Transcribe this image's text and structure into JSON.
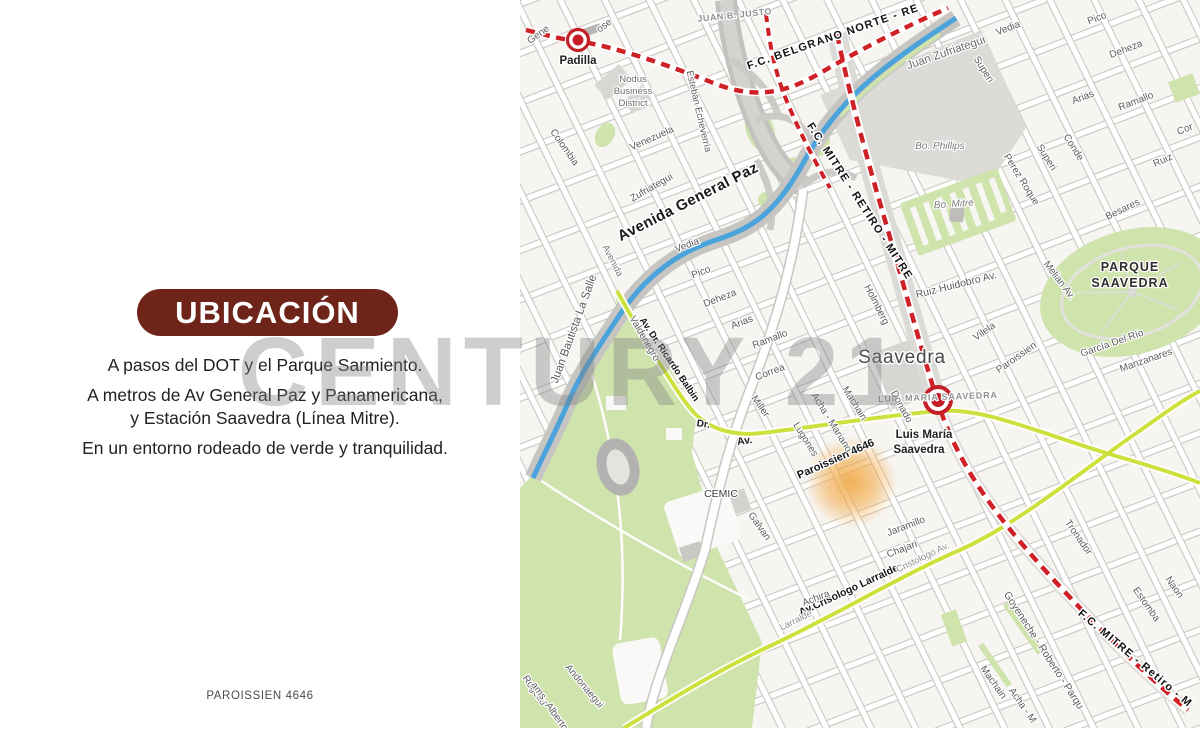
{
  "left_panel": {
    "title": "UBICACIÓN",
    "lines": [
      "A pasos del DOT y el Parque Sarmiento.",
      "A metros de Av General Paz y Panamericana,",
      "y Estación Saavedra (Línea Mitre).",
      "En un entorno rodeado de verde y tranquilidad."
    ],
    "footer": "PAROISSIEN 4646",
    "accent_color": "#6e2418"
  },
  "watermark": "CENTURY 21",
  "map": {
    "place": "Saavedra",
    "property_marker": "Paroissien 4646",
    "colors": {
      "railway_red": "#cf2026",
      "avenue_green": "#cde13e",
      "park_green": "#cfe3ad",
      "highway_blue": "#4aa3da",
      "highlight_orange": "#f1a43b",
      "station_red": "#c41e28",
      "map_background": "#f7f5f2"
    },
    "stations": [
      {
        "name": "Padilla"
      },
      {
        "name": "Luis María Saavedra"
      }
    ],
    "labels": [
      {
        "t": "F.C. MITRE - RETIRO - MITRE",
        "x": 337,
        "y": 203,
        "r": 57,
        "s": 11,
        "w": "bold",
        "c": "#121212",
        "ls": 1.2,
        "h": 3
      },
      {
        "t": "F.C. BELGRANO NORTE - RE",
        "x": 314,
        "y": 40,
        "r": -19,
        "s": 11,
        "w": "bold",
        "c": "#121212",
        "ls": 1.2,
        "h": 3
      },
      {
        "t": "F.C. MITRE - Retiro - M",
        "x": 613,
        "y": 661,
        "r": 40,
        "s": 11,
        "w": "bold",
        "c": "#121212",
        "ls": 1.2,
        "h": 3
      },
      {
        "t": "Avenida General Paz",
        "x": 170,
        "y": 206,
        "r": -27,
        "s": 15,
        "w": "bold",
        "c": "#1a1a1a",
        "ls": 0.4,
        "h": 3.2
      },
      {
        "t": "Av.Crisologo Larralde",
        "x": 330,
        "y": 593,
        "r": -25,
        "s": 10.5,
        "w": "bold",
        "c": "#161616",
        "h": 2.8
      },
      {
        "t": "Av. Dr. Ricardo Balbin",
        "x": 147,
        "y": 361,
        "r": 56,
        "s": 9.5,
        "w": "bold",
        "c": "#161616",
        "h": 2.6
      },
      {
        "t": "Paroissien 4646",
        "x": 317,
        "y": 462,
        "r": -24,
        "s": 11,
        "w": "bold",
        "c": "#161616",
        "h": 2.8
      },
      {
        "t": "PARQUE",
        "x": 610,
        "y": 271,
        "r": 0,
        "s": 12.5,
        "w": "bold",
        "c": "#2e2e2e",
        "ls": 1,
        "h": 2.6
      },
      {
        "t": "SAAVEDRA",
        "x": 610,
        "y": 287,
        "r": 0,
        "s": 12.5,
        "w": "bold",
        "c": "#2e2e2e",
        "ls": 1,
        "h": 2.6
      },
      {
        "t": "Saavedra",
        "x": 382,
        "y": 363,
        "r": 0,
        "s": 19,
        "c": "#484848",
        "ls": 0.8,
        "h": 3
      },
      {
        "t": "Padilla",
        "x": 58,
        "y": 64,
        "r": 0,
        "s": 11.5,
        "w": "bold",
        "c": "#1f1f1f",
        "h": 3
      },
      {
        "t": "Luis María",
        "x": 404,
        "y": 438,
        "r": 0,
        "s": 11.5,
        "w": "bold",
        "c": "#1f1f1f",
        "h": 3
      },
      {
        "t": "Saavedra",
        "x": 399,
        "y": 453,
        "r": 0,
        "s": 11.5,
        "w": "bold",
        "c": "#1f1f1f",
        "h": 3
      },
      {
        "t": "LUIS MARIA SAAVEDRA",
        "x": 418,
        "y": 400,
        "r": -2,
        "s": 9,
        "w": "bold",
        "c": "#909090",
        "ls": 0.8
      },
      {
        "t": "Dr.",
        "x": 183,
        "y": 427,
        "r": 8,
        "s": 10,
        "w": "bold",
        "c": "#1c1c1c"
      },
      {
        "t": "Av.",
        "x": 225,
        "y": 444,
        "r": -8,
        "s": 10.5,
        "w": "bold",
        "c": "#1c1c1c"
      },
      {
        "t": "CEMIC",
        "x": 201,
        "y": 497,
        "r": 0,
        "s": 10.5,
        "c": "#3d3d3d"
      },
      {
        "t": "Vedia",
        "x": 168,
        "y": 248,
        "r": -21
      },
      {
        "t": "Pico",
        "x": 182,
        "y": 275,
        "r": -21
      },
      {
        "t": "Deheza",
        "x": 201,
        "y": 301,
        "r": -21
      },
      {
        "t": "Arias",
        "x": 223,
        "y": 325,
        "r": -21
      },
      {
        "t": "Ramallo",
        "x": 251,
        "y": 342,
        "r": -21
      },
      {
        "t": "Correa",
        "x": 251,
        "y": 375,
        "r": -21
      },
      {
        "t": "Vedia",
        "x": 489,
        "y": 31,
        "r": -21
      },
      {
        "t": "Pico",
        "x": 578,
        "y": 21,
        "r": -21
      },
      {
        "t": "Deheza",
        "x": 607,
        "y": 52,
        "r": -21
      },
      {
        "t": "Arias",
        "x": 564,
        "y": 100,
        "r": -21
      },
      {
        "t": "Ramallo",
        "x": 617,
        "y": 104,
        "r": -21
      },
      {
        "t": "Cor",
        "x": 666,
        "y": 132,
        "r": -21
      },
      {
        "t": "Ruiz",
        "x": 644,
        "y": 163,
        "r": -24
      },
      {
        "t": "Ruiz Huidobro Av.",
        "x": 437,
        "y": 288,
        "r": -14,
        "s": 10.5
      },
      {
        "t": "Besares",
        "x": 604,
        "y": 212,
        "r": -26
      },
      {
        "t": "García Del Río",
        "x": 593,
        "y": 346,
        "r": -19
      },
      {
        "t": "Manzanares",
        "x": 627,
        "y": 363,
        "r": -19
      },
      {
        "t": "Jaramillo",
        "x": 387,
        "y": 529,
        "r": -21
      },
      {
        "t": "Chajari",
        "x": 383,
        "y": 552,
        "r": -21
      },
      {
        "t": "Achira",
        "x": 297,
        "y": 601,
        "r": -21
      },
      {
        "t": "Venezuela",
        "x": 133,
        "y": 141,
        "r": -24
      },
      {
        "t": "Gene",
        "x": 20,
        "y": 37,
        "r": -36
      },
      {
        "t": "ose",
        "x": 86,
        "y": 28,
        "r": -36
      },
      {
        "t": "Colombia",
        "x": 42,
        "y": 149,
        "r": 55
      },
      {
        "t": "Esteban Echeverría",
        "x": 176,
        "y": 112,
        "r": 77,
        "s": 9.5
      },
      {
        "t": "Valdenegro",
        "x": 122,
        "y": 340,
        "r": 60
      },
      {
        "t": "Holmberg",
        "x": 354,
        "y": 306,
        "r": 63
      },
      {
        "t": "Donado",
        "x": 379,
        "y": 408,
        "r": 62
      },
      {
        "t": "Superi",
        "x": 461,
        "y": 71,
        "r": 58
      },
      {
        "t": "Superi",
        "x": 524,
        "y": 159,
        "r": 58
      },
      {
        "t": "Conde",
        "x": 551,
        "y": 149,
        "r": 58
      },
      {
        "t": "Perez Roque",
        "x": 499,
        "y": 181,
        "r": 58
      },
      {
        "t": "Melian Av.",
        "x": 537,
        "y": 282,
        "r": 53
      },
      {
        "t": "Lugones",
        "x": 283,
        "y": 441,
        "r": 58
      },
      {
        "t": "Acha - Mariano",
        "x": 309,
        "y": 424,
        "r": 58
      },
      {
        "t": "Machain",
        "x": 332,
        "y": 405,
        "r": 58
      },
      {
        "t": "Miller",
        "x": 238,
        "y": 408,
        "r": 55
      },
      {
        "t": "Galvan",
        "x": 237,
        "y": 528,
        "r": 55
      },
      {
        "t": "Andonaegui",
        "x": 62,
        "y": 688,
        "r": 50
      },
      {
        "t": "Rogelio",
        "x": 12,
        "y": 692,
        "r": 55
      },
      {
        "t": "ams.-Alberto",
        "x": 27,
        "y": 708,
        "r": 55
      },
      {
        "t": "Goyeneche - Roberto - Parqu",
        "x": 521,
        "y": 652,
        "r": 57,
        "s": 10.5
      },
      {
        "t": "Tronador",
        "x": 556,
        "y": 539,
        "r": 55
      },
      {
        "t": "Estomba",
        "x": 624,
        "y": 606,
        "r": 55
      },
      {
        "t": "Naon",
        "x": 652,
        "y": 589,
        "r": 55
      },
      {
        "t": "Machain",
        "x": 471,
        "y": 684,
        "r": 55
      },
      {
        "t": "Acha - M",
        "x": 500,
        "y": 707,
        "r": 55
      },
      {
        "t": "Juan Bautista La Salle",
        "x": 57,
        "y": 330,
        "r": -70,
        "s": 11.5
      },
      {
        "t": "Juan Zufriategui",
        "x": 427,
        "y": 56,
        "r": -19,
        "s": 11.5,
        "c": "#6b6b6b"
      },
      {
        "t": "Zufriategui",
        "x": 133,
        "y": 190,
        "r": -30
      },
      {
        "t": "JUAN B. JUSTO",
        "x": 215,
        "y": 18,
        "r": -6,
        "s": 9,
        "w": "bold",
        "c": "#8f8f8f",
        "ls": 0.5
      },
      {
        "t": "Bo. Phillips",
        "x": 420,
        "y": 149,
        "r": 0,
        "s": 10,
        "i": 1,
        "c": "#7c7c7c"
      },
      {
        "t": "Bo. Mitre",
        "x": 434,
        "y": 207,
        "r": -4,
        "s": 10,
        "i": 1,
        "c": "#7c7c7c"
      },
      {
        "t": "Nodus",
        "x": 113,
        "y": 82,
        "r": 0,
        "s": 9.5,
        "c": "#6e6e6e"
      },
      {
        "t": "Business",
        "x": 113,
        "y": 94,
        "r": 0,
        "s": 9.5,
        "c": "#6e6e6e"
      },
      {
        "t": "District",
        "x": 113,
        "y": 106,
        "r": 0,
        "s": 9.5,
        "c": "#6e6e6e"
      },
      {
        "t": "Avenida",
        "x": 90,
        "y": 262,
        "r": 63,
        "s": 9.5,
        "c": "#787878"
      },
      {
        "t": "Larralde",
        "x": 277,
        "y": 623,
        "r": -26,
        "s": 9.5,
        "c": "#8f8f8f"
      },
      {
        "t": "Cristologo Av.",
        "x": 404,
        "y": 560,
        "r": -26,
        "s": 9.5,
        "c": "#8f8f8f"
      },
      {
        "t": "Vilela",
        "x": 466,
        "y": 334,
        "r": -35
      },
      {
        "t": "Paroissien",
        "x": 498,
        "y": 360,
        "r": -35
      }
    ]
  }
}
